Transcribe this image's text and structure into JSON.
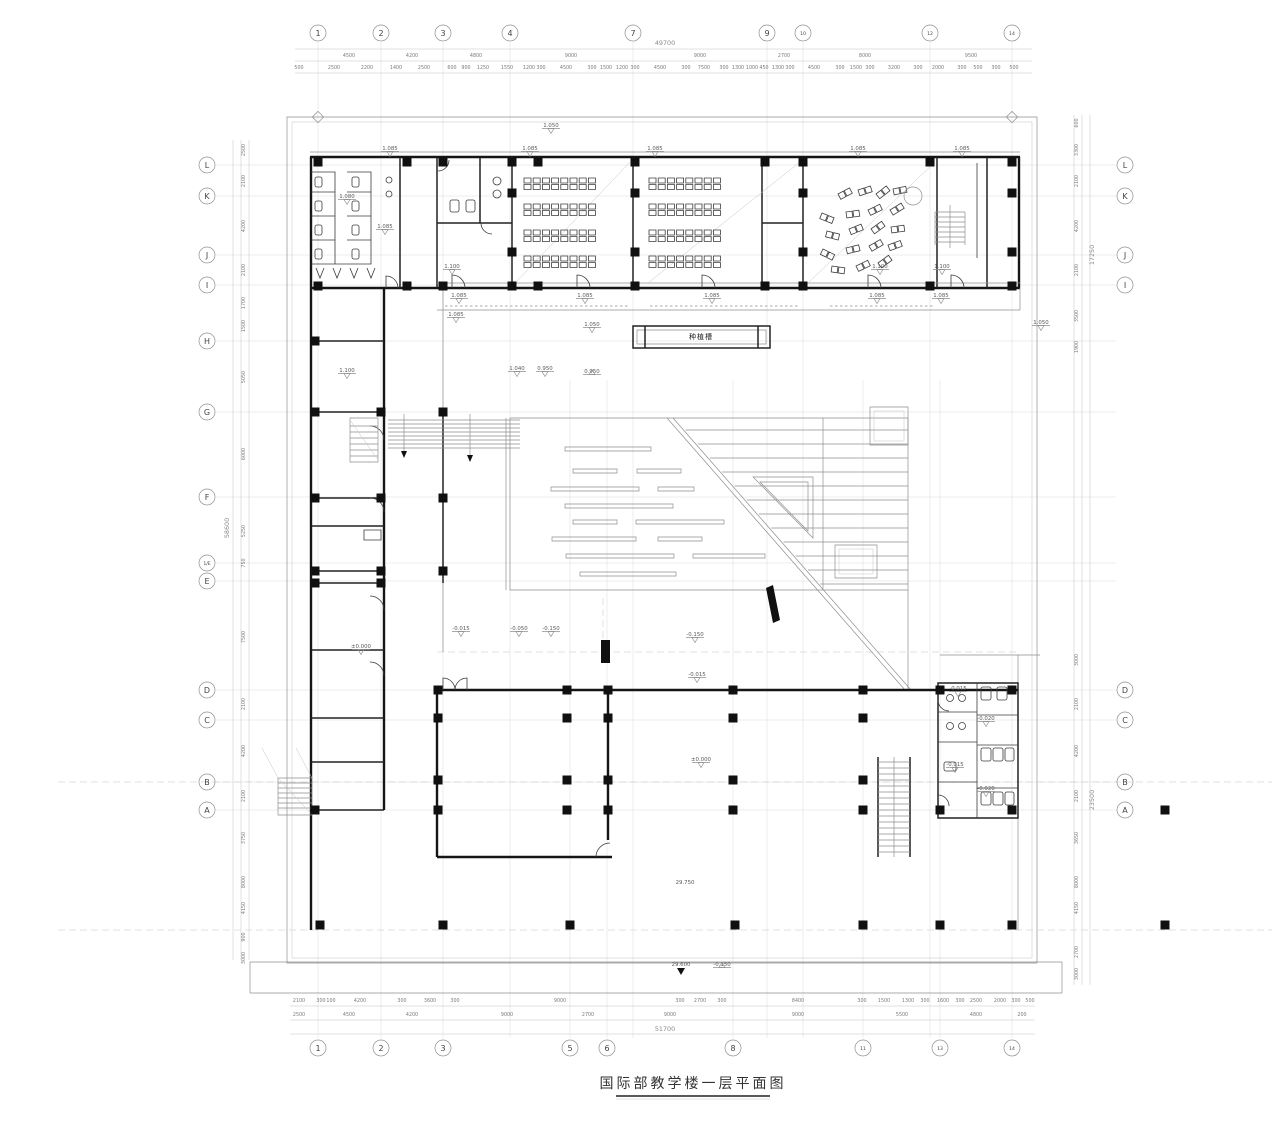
{
  "title": {
    "text": "国际部教学楼一层平面图"
  },
  "drawing": {
    "axes": {
      "top": [
        {
          "n": "1",
          "x": 318
        },
        {
          "n": "2",
          "x": 381
        },
        {
          "n": "3",
          "x": 443
        },
        {
          "n": "4",
          "x": 510
        },
        {
          "n": "7",
          "x": 633
        },
        {
          "n": "9",
          "x": 767
        },
        {
          "n": "10",
          "x": 803
        },
        {
          "n": "12",
          "x": 930
        },
        {
          "n": "14",
          "x": 1012
        }
      ],
      "bottom": [
        {
          "n": "1",
          "x": 318
        },
        {
          "n": "2",
          "x": 381
        },
        {
          "n": "3",
          "x": 443
        },
        {
          "n": "5",
          "x": 570
        },
        {
          "n": "6",
          "x": 607
        },
        {
          "n": "8",
          "x": 733
        },
        {
          "n": "11",
          "x": 863
        },
        {
          "n": "13",
          "x": 940
        },
        {
          "n": "14",
          "x": 1012
        }
      ],
      "left": [
        {
          "n": "L",
          "y": 165
        },
        {
          "n": "K",
          "y": 196
        },
        {
          "n": "J",
          "y": 255
        },
        {
          "n": "I",
          "y": 285
        },
        {
          "n": "H",
          "y": 341
        },
        {
          "n": "G",
          "y": 412
        },
        {
          "n": "F",
          "y": 497
        },
        {
          "n": "1/E",
          "y": 563
        },
        {
          "n": "E",
          "y": 581
        },
        {
          "n": "D",
          "y": 690
        },
        {
          "n": "C",
          "y": 720
        },
        {
          "n": "B",
          "y": 782
        },
        {
          "n": "A",
          "y": 810
        }
      ],
      "right": [
        {
          "n": "L",
          "y": 165
        },
        {
          "n": "K",
          "y": 196
        },
        {
          "n": "J",
          "y": 255
        },
        {
          "n": "I",
          "y": 285
        },
        {
          "n": "D",
          "y": 690
        },
        {
          "n": "C",
          "y": 720
        },
        {
          "n": "B",
          "y": 782
        },
        {
          "n": "A",
          "y": 810
        }
      ]
    },
    "dimensions": {
      "top_total": [
        [
          "49700",
          665
        ]
      ],
      "top_major": [
        [
          "4500",
          349
        ],
        [
          "4200",
          412
        ],
        [
          "4800",
          476
        ],
        [
          "9000",
          571
        ],
        [
          "9000",
          700
        ],
        [
          "2700",
          784
        ],
        [
          "8000",
          865
        ],
        [
          "9500",
          971
        ]
      ],
      "top_minor": [
        [
          "500",
          299
        ],
        [
          "2500",
          334
        ],
        [
          "2200",
          367
        ],
        [
          "1400",
          396
        ],
        [
          "2500",
          424
        ],
        [
          "600",
          452
        ],
        [
          "900",
          466
        ],
        [
          "1250",
          483
        ],
        [
          "1550",
          507
        ],
        [
          "1200",
          529
        ],
        [
          "300",
          541
        ],
        [
          "4500",
          566
        ],
        [
          "300",
          592
        ],
        [
          "1500",
          606
        ],
        [
          "1200",
          622
        ],
        [
          "300",
          635
        ],
        [
          "4500",
          660
        ],
        [
          "300",
          686
        ],
        [
          "7500",
          704
        ],
        [
          "300",
          724
        ],
        [
          "1300",
          738
        ],
        [
          "1000",
          752
        ],
        [
          "450",
          764
        ],
        [
          "1300",
          778
        ],
        [
          "300",
          790
        ],
        [
          "4500",
          814
        ],
        [
          "300",
          840
        ],
        [
          "1500",
          856
        ],
        [
          "300",
          870
        ],
        [
          "3200",
          894
        ],
        [
          "300",
          918
        ],
        [
          "2000",
          938
        ],
        [
          "300",
          962
        ],
        [
          "500",
          978
        ],
        [
          "300",
          996
        ],
        [
          "500",
          1014
        ]
      ],
      "bottom_minor": [
        [
          "2100",
          299
        ],
        [
          "300",
          321
        ],
        [
          "100",
          331
        ],
        [
          "4200",
          360
        ],
        [
          "300",
          402
        ],
        [
          "3600",
          430
        ],
        [
          "300",
          455
        ],
        [
          "9000",
          560
        ],
        [
          "300",
          680
        ],
        [
          "2700",
          700
        ],
        [
          "300",
          722
        ],
        [
          "8400",
          798
        ],
        [
          "300",
          862
        ],
        [
          "1500",
          884
        ],
        [
          "1300",
          908
        ],
        [
          "300",
          925
        ],
        [
          "1600",
          943
        ],
        [
          "300",
          960
        ],
        [
          "2500",
          976
        ],
        [
          "2000",
          1000
        ],
        [
          "300",
          1016
        ],
        [
          "500",
          1030
        ]
      ],
      "bottom_major": [
        [
          "2500",
          299
        ],
        [
          "4500",
          349
        ],
        [
          "4200",
          412
        ],
        [
          "9000",
          507
        ],
        [
          "2700",
          588
        ],
        [
          "9000",
          670
        ],
        [
          "9000",
          798
        ],
        [
          "5500",
          902
        ],
        [
          "4800",
          976
        ],
        [
          "200",
          1022
        ]
      ],
      "bottom_total": [
        [
          "51700",
          665
        ]
      ],
      "left": [
        [
          "2500",
          150
        ],
        [
          "2100",
          181
        ],
        [
          "4200",
          226
        ],
        [
          "2100",
          270
        ],
        [
          "1700",
          303
        ],
        [
          "1500",
          326
        ],
        [
          "5050",
          377
        ],
        [
          "6000",
          454
        ],
        [
          "5250",
          531
        ],
        [
          "750",
          563
        ],
        [
          "7500",
          637
        ],
        [
          "2100",
          704
        ],
        [
          "4200",
          751
        ],
        [
          "2100",
          796
        ],
        [
          "3750",
          838
        ],
        [
          "8000",
          882
        ],
        [
          "4150",
          908
        ],
        [
          "900",
          937
        ],
        [
          "3000",
          958
        ]
      ],
      "left_total": [
        [
          "58600",
          528
        ]
      ],
      "right": [
        [
          "600",
          123
        ],
        [
          "3300",
          150
        ],
        [
          "2100",
          181
        ],
        [
          "4200",
          226
        ],
        [
          "2100",
          270
        ],
        [
          "3500",
          316
        ],
        [
          "1900",
          347
        ],
        [
          "3000",
          660
        ],
        [
          "2100",
          704
        ],
        [
          "4200",
          751
        ],
        [
          "2100",
          796
        ],
        [
          "3650",
          838
        ],
        [
          "8000",
          882
        ],
        [
          "4150",
          908
        ],
        [
          "2700",
          952
        ],
        [
          "3000",
          974
        ]
      ],
      "right_totals": [
        [
          "17250",
          255
        ],
        [
          "23500",
          800
        ]
      ]
    },
    "levels": [
      {
        "t": "1.050",
        "x": 551,
        "y": 127,
        "m": "down"
      },
      {
        "t": "1.085",
        "x": 390,
        "y": 150,
        "m": "down"
      },
      {
        "t": "1.085",
        "x": 530,
        "y": 150,
        "m": "down"
      },
      {
        "t": "1.085",
        "x": 655,
        "y": 150,
        "m": "down"
      },
      {
        "t": "1.085",
        "x": 858,
        "y": 150,
        "m": "down"
      },
      {
        "t": "1.085",
        "x": 962,
        "y": 150,
        "m": "down"
      },
      {
        "t": "1.080",
        "x": 347,
        "y": 198,
        "m": "down"
      },
      {
        "t": "1.085",
        "x": 385,
        "y": 228,
        "m": "down"
      },
      {
        "t": "1.100",
        "x": 452,
        "y": 268,
        "m": "down"
      },
      {
        "t": "1.100",
        "x": 880,
        "y": 268,
        "m": "down"
      },
      {
        "t": "1.100",
        "x": 942,
        "y": 268,
        "m": "down"
      },
      {
        "t": "1.085",
        "x": 459,
        "y": 297,
        "m": "down"
      },
      {
        "t": "1.085",
        "x": 585,
        "y": 297,
        "m": "down"
      },
      {
        "t": "1.085",
        "x": 712,
        "y": 297,
        "m": "down"
      },
      {
        "t": "1.085",
        "x": 877,
        "y": 297,
        "m": "down"
      },
      {
        "t": "1.085",
        "x": 941,
        "y": 297,
        "m": "down"
      },
      {
        "t": "1.085",
        "x": 456,
        "y": 316,
        "m": "down"
      },
      {
        "t": "1.050",
        "x": 592,
        "y": 326,
        "m": "down"
      },
      {
        "t": "1.050",
        "x": 1041,
        "y": 324,
        "m": "down"
      },
      {
        "t": "1.100",
        "x": 347,
        "y": 372,
        "m": "down"
      },
      {
        "t": "1.040",
        "x": 517,
        "y": 370,
        "m": "down"
      },
      {
        "t": "0.950",
        "x": 545,
        "y": 370,
        "m": "down"
      },
      {
        "t": "0.950",
        "x": 592,
        "y": 373,
        "m": "up"
      },
      {
        "t": "±0.000",
        "x": 361,
        "y": 648,
        "m": "down"
      },
      {
        "t": "-0.015",
        "x": 461,
        "y": 630,
        "m": "down"
      },
      {
        "t": "-0.050",
        "x": 519,
        "y": 630,
        "m": "down"
      },
      {
        "t": "-0.150",
        "x": 551,
        "y": 630,
        "m": "down"
      },
      {
        "t": "-0.150",
        "x": 695,
        "y": 636,
        "m": "down"
      },
      {
        "t": "-0.015",
        "x": 697,
        "y": 676,
        "m": "down"
      },
      {
        "t": "±0.000",
        "x": 701,
        "y": 761,
        "m": "down"
      },
      {
        "t": "-0.015",
        "x": 958,
        "y": 690,
        "m": "down"
      },
      {
        "t": "-0.020",
        "x": 986,
        "y": 720,
        "m": "down"
      },
      {
        "t": "-0.015",
        "x": 955,
        "y": 766,
        "m": "down"
      },
      {
        "t": "-0.020",
        "x": 986,
        "y": 790,
        "m": "down"
      },
      {
        "t": "29.750",
        "x": 685,
        "y": 884,
        "m": "none"
      },
      {
        "t": "29.600",
        "x": 681,
        "y": 966,
        "m": "filled"
      },
      {
        "t": "-0.150",
        "x": 722,
        "y": 966,
        "m": "up"
      }
    ],
    "labels": [
      {
        "t": "种植槽",
        "x": 701,
        "y": 339
      }
    ],
    "columns": [
      [
        318,
        162
      ],
      [
        407,
        162
      ],
      [
        443,
        162
      ],
      [
        512,
        162
      ],
      [
        538,
        162
      ],
      [
        635,
        162
      ],
      [
        765,
        162
      ],
      [
        803,
        162
      ],
      [
        930,
        162
      ],
      [
        1012,
        162
      ],
      [
        318,
        286
      ],
      [
        407,
        286
      ],
      [
        443,
        286
      ],
      [
        512,
        286
      ],
      [
        538,
        286
      ],
      [
        635,
        286
      ],
      [
        765,
        286
      ],
      [
        803,
        286
      ],
      [
        930,
        286
      ],
      [
        1012,
        286
      ],
      [
        512,
        193
      ],
      [
        512,
        252
      ],
      [
        635,
        193
      ],
      [
        635,
        252
      ],
      [
        803,
        193
      ],
      [
        803,
        252
      ],
      [
        1012,
        193
      ],
      [
        1012,
        252
      ],
      [
        315,
        341
      ],
      [
        315,
        412
      ],
      [
        381,
        412
      ],
      [
        443,
        412
      ],
      [
        315,
        498
      ],
      [
        381,
        498
      ],
      [
        443,
        498
      ],
      [
        315,
        571
      ],
      [
        381,
        571
      ],
      [
        443,
        571
      ],
      [
        315,
        583
      ],
      [
        381,
        583
      ],
      [
        438,
        690
      ],
      [
        567,
        690
      ],
      [
        608,
        690
      ],
      [
        733,
        690
      ],
      [
        863,
        690
      ],
      [
        438,
        718
      ],
      [
        567,
        718
      ],
      [
        608,
        718
      ],
      [
        733,
        718
      ],
      [
        863,
        718
      ],
      [
        438,
        780
      ],
      [
        567,
        780
      ],
      [
        608,
        780
      ],
      [
        733,
        780
      ],
      [
        863,
        780
      ],
      [
        438,
        810
      ],
      [
        567,
        810
      ],
      [
        608,
        810
      ],
      [
        733,
        810
      ],
      [
        863,
        810
      ],
      [
        940,
        690
      ],
      [
        1012,
        690
      ],
      [
        940,
        810
      ],
      [
        1012,
        810
      ],
      [
        315,
        810
      ],
      [
        320,
        925
      ],
      [
        443,
        925
      ],
      [
        570,
        925
      ],
      [
        735,
        925
      ],
      [
        863,
        925
      ],
      [
        940,
        925
      ],
      [
        1012,
        925
      ],
      [
        1165,
        810
      ],
      [
        1165,
        925
      ]
    ],
    "desk_rooms": [
      {
        "x0": 524,
        "cols": 8
      },
      {
        "x0": 649,
        "cols": 8
      }
    ],
    "desk_bands": [
      178,
      204,
      230,
      256
    ],
    "loose_seats": [
      [
        838,
        194,
        -28
      ],
      [
        858,
        190,
        -18
      ],
      [
        876,
        194,
        -38
      ],
      [
        893,
        189,
        -12
      ],
      [
        822,
        213,
        22
      ],
      [
        846,
        212,
        -8
      ],
      [
        868,
        210,
        -26
      ],
      [
        890,
        210,
        -32
      ],
      [
        827,
        231,
        14
      ],
      [
        849,
        229,
        -22
      ],
      [
        871,
        229,
        -36
      ],
      [
        891,
        227,
        -8
      ],
      [
        823,
        249,
        26
      ],
      [
        846,
        248,
        -14
      ],
      [
        869,
        246,
        -30
      ],
      [
        888,
        245,
        -20
      ],
      [
        832,
        266,
        8
      ],
      [
        856,
        266,
        -26
      ],
      [
        878,
        263,
        -36
      ]
    ],
    "benches": [
      [
        565,
        447,
        86
      ],
      [
        573,
        469,
        44
      ],
      [
        637,
        469,
        44
      ],
      [
        551,
        487,
        88
      ],
      [
        658,
        487,
        36
      ],
      [
        565,
        504,
        108
      ],
      [
        573,
        520,
        44
      ],
      [
        636,
        520,
        88
      ],
      [
        552,
        537,
        84
      ],
      [
        658,
        537,
        44
      ],
      [
        566,
        554,
        108
      ],
      [
        693,
        554,
        72
      ],
      [
        580,
        572,
        96
      ]
    ]
  }
}
